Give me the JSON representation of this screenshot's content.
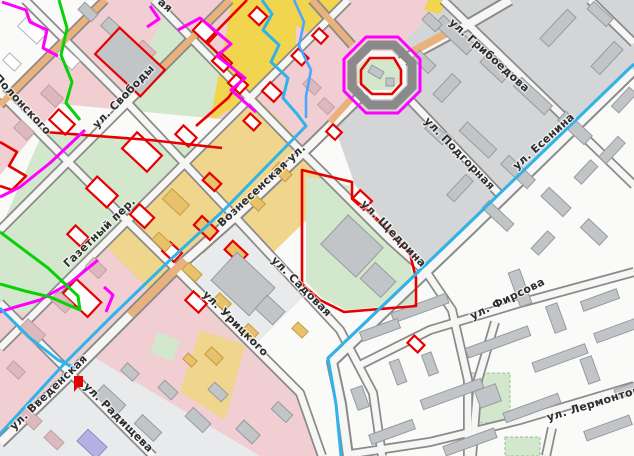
{
  "map": {
    "streets": [
      {
        "name": "ул. Грибоедова"
      },
      {
        "name": "ул. Подгорная"
      },
      {
        "name": "ул. Есенина"
      },
      {
        "name": "ул. Свободы"
      },
      {
        "name": "Вознесенская ул."
      },
      {
        "name": "ул. Щедрина"
      },
      {
        "name": "ул. Садовая"
      },
      {
        "name": "ул. Урицкого"
      },
      {
        "name": "Газетный пер."
      },
      {
        "name": "Полонского"
      },
      {
        "name": "ул. Введенская"
      },
      {
        "name": "ул. Радищева"
      },
      {
        "name": "ул. Фирсова"
      },
      {
        "name": "ул. Лермонтова"
      }
    ],
    "partial_labels": [
      {
        "name": "ая"
      }
    ],
    "colors": {
      "pink_zone": "#f1ced2",
      "yellow_zone": "#f0d58c",
      "bright_yellow": "#f2d54e",
      "green_zone": "#d2e7cc",
      "gray_zone": "#d3d5d7",
      "graylight_zone": "#e9eaec",
      "white_zone": "#fafaf8",
      "road": "#8a8a8a",
      "road_fill": "#f6f6f4",
      "highlight_road": "#e9b27c",
      "stream": "#2fb3e8",
      "stream_light": "#4da6ff",
      "boundary_magenta": "#ff00ff",
      "boundary_green": "#0ad00a",
      "boundary_red": "#e60000",
      "building_gray": "#c2c5c8",
      "label": "#2e2e2e"
    }
  }
}
